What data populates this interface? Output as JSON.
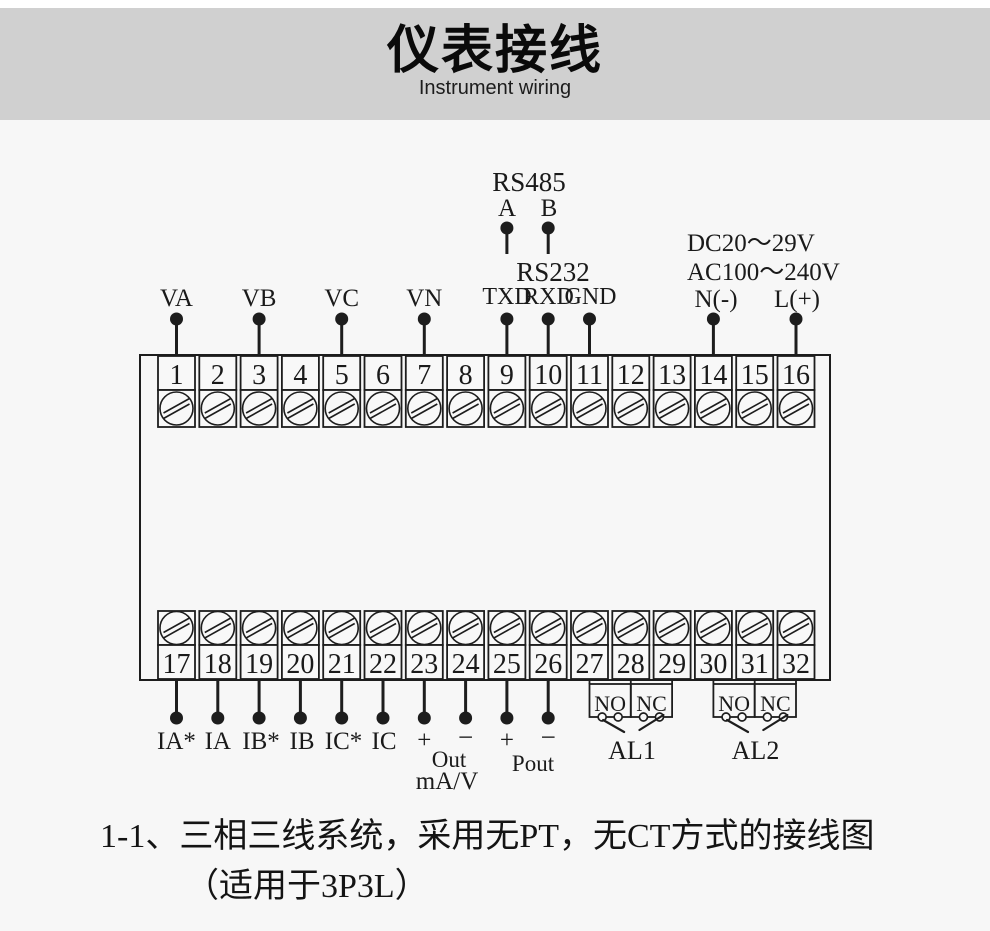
{
  "header": {
    "title": "仪表接线",
    "subtitle": "Instrument wiring"
  },
  "comm": {
    "rs485": {
      "title": "RS485",
      "a": "A",
      "b": "B"
    },
    "rs232": {
      "title": "RS232",
      "txd": "TXD",
      "rxd": "RXD",
      "gnd": "GND"
    }
  },
  "power": {
    "dc": "DC20～29V",
    "ac": "AC100～240V",
    "n": "N(-)",
    "l": "L(+)"
  },
  "voltage_inputs": [
    "VA",
    "VB",
    "VC",
    "VN"
  ],
  "terminals": {
    "top": [
      "1",
      "2",
      "3",
      "4",
      "5",
      "6",
      "7",
      "8",
      "9",
      "10",
      "11",
      "12",
      "13",
      "14",
      "15",
      "16"
    ],
    "bottom": [
      "17",
      "18",
      "19",
      "20",
      "21",
      "22",
      "23",
      "24",
      "25",
      "26",
      "27",
      "28",
      "29",
      "30",
      "31",
      "32"
    ]
  },
  "current_inputs": [
    "IA*",
    "IA",
    "IB*",
    "IB",
    "IC*",
    "IC"
  ],
  "analog_out": {
    "plus": "+",
    "minus": "−",
    "label": "Out",
    "unit": "mA/V"
  },
  "pulse_out": {
    "plus": "+",
    "minus": "−",
    "label": "Pout"
  },
  "relays": [
    {
      "no": "NO",
      "nc": "NC",
      "label": "AL1"
    },
    {
      "no": "NO",
      "nc": "NC",
      "label": "AL2"
    }
  ],
  "caption": {
    "line1": "1-1、三相三线系统，采用无PT，无CT方式的接线图",
    "line2": "（适用于3P3L）"
  },
  "colors": {
    "header_bg": "#d0d0d0",
    "page_bg": "#f7f7f7",
    "ink": "#1d1d1d"
  }
}
